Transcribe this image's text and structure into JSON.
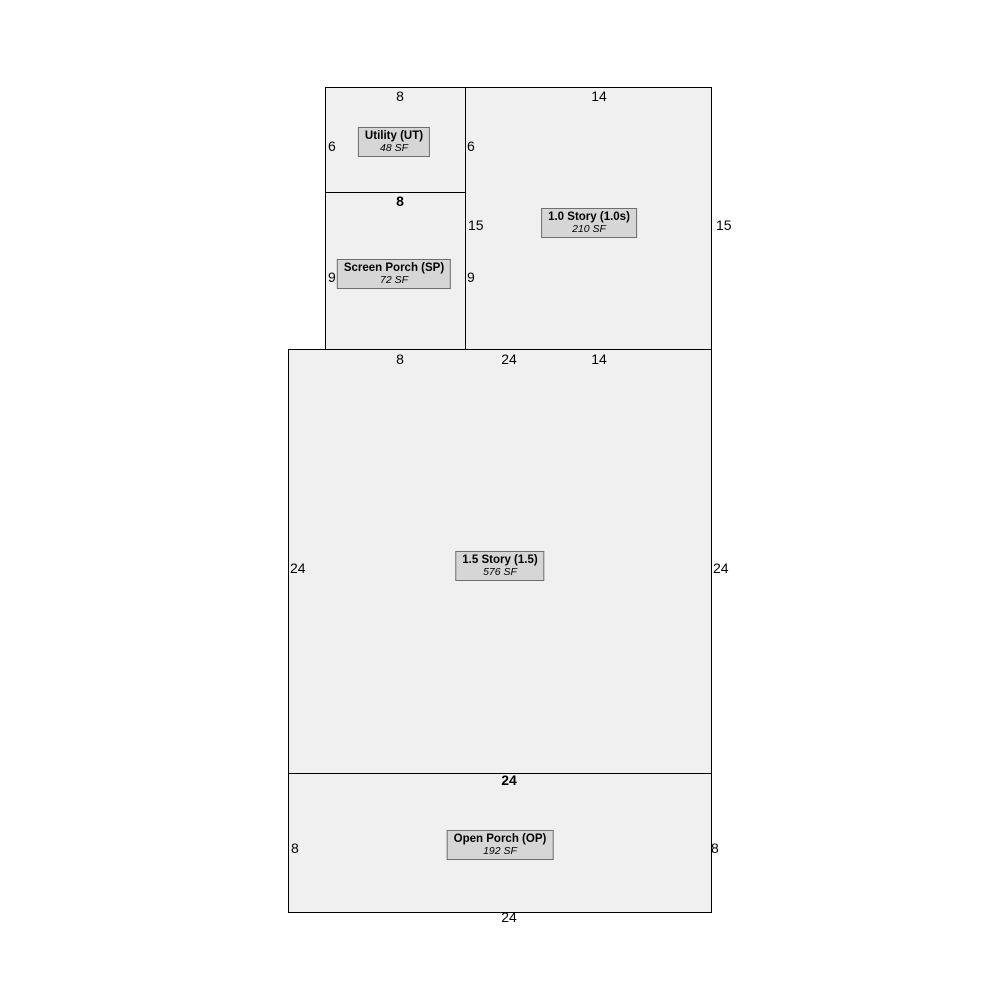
{
  "sketch": {
    "background_color": "#ffffff",
    "region_fill_color": "#f0f0f0",
    "region_border_color": "#000000",
    "label_fill_color": "#d6d6d6",
    "label_border_color": "#6e6e6e",
    "text_color": "#000000"
  },
  "areas": [
    {
      "id": "utility",
      "label": "Utility (UT)",
      "area": "48 SF",
      "rect": {
        "x": 325,
        "y": 87,
        "w": 141,
        "h": 106
      },
      "label_center": {
        "x": 394,
        "y": 142
      }
    },
    {
      "id": "one-story",
      "label": "1.0 Story (1.0s)",
      "area": "210 SF",
      "rect": {
        "x": 465,
        "y": 87,
        "w": 247,
        "h": 263
      },
      "label_center": {
        "x": 589,
        "y": 223
      }
    },
    {
      "id": "screen-porch",
      "label": "Screen Porch (SP)",
      "area": "72 SF",
      "rect": {
        "x": 325,
        "y": 192,
        "w": 141,
        "h": 158
      },
      "label_center": {
        "x": 394,
        "y": 274
      }
    },
    {
      "id": "one-half-story",
      "label": "1.5 Story (1.5)",
      "area": "576 SF",
      "rect": {
        "x": 288,
        "y": 349,
        "w": 424,
        "h": 425
      },
      "label_center": {
        "x": 500,
        "y": 566
      }
    },
    {
      "id": "open-porch",
      "label": "Open Porch (OP)",
      "area": "192 SF",
      "rect": {
        "x": 288,
        "y": 773,
        "w": 424,
        "h": 140
      },
      "label_center": {
        "x": 500,
        "y": 845
      }
    }
  ],
  "dimensions": [
    {
      "value": "8",
      "edge": "utility-top",
      "x": 400,
      "y": 96,
      "anchor": "center",
      "bold": false
    },
    {
      "value": "14",
      "edge": "one-story-top",
      "x": 599,
      "y": 96,
      "anchor": "center",
      "bold": false
    },
    {
      "value": "6",
      "edge": "utility-left",
      "x": 328,
      "y": 146,
      "anchor": "left",
      "bold": false
    },
    {
      "value": "6",
      "edge": "utility-right",
      "x": 467,
      "y": 146,
      "anchor": "left",
      "bold": false
    },
    {
      "value": "8",
      "edge": "utility-bottom",
      "x": 400,
      "y": 201,
      "anchor": "center",
      "bold": true
    },
    {
      "value": "15",
      "edge": "one-story-left",
      "x": 468,
      "y": 225,
      "anchor": "left",
      "bold": false
    },
    {
      "value": "15",
      "edge": "one-story-right",
      "x": 716,
      "y": 225,
      "anchor": "left",
      "bold": false
    },
    {
      "value": "9",
      "edge": "screen-porch-left",
      "x": 328,
      "y": 277,
      "anchor": "left",
      "bold": false
    },
    {
      "value": "9",
      "edge": "screen-porch-right",
      "x": 467,
      "y": 277,
      "anchor": "left",
      "bold": false
    },
    {
      "value": "8",
      "edge": "screen-porch-bottom",
      "x": 400,
      "y": 359,
      "anchor": "center",
      "bold": false
    },
    {
      "value": "24",
      "edge": "one-half-story-top",
      "x": 509,
      "y": 359,
      "anchor": "center",
      "bold": false
    },
    {
      "value": "14",
      "edge": "one-story-bottom",
      "x": 599,
      "y": 359,
      "anchor": "center",
      "bold": false
    },
    {
      "value": "24",
      "edge": "one-half-story-left",
      "x": 290,
      "y": 568,
      "anchor": "left",
      "bold": false
    },
    {
      "value": "24",
      "edge": "one-half-story-right",
      "x": 713,
      "y": 568,
      "anchor": "left",
      "bold": false
    },
    {
      "value": "24",
      "edge": "open-porch-top",
      "x": 509,
      "y": 780,
      "anchor": "center",
      "bold": true
    },
    {
      "value": "8",
      "edge": "open-porch-left",
      "x": 291,
      "y": 848,
      "anchor": "left",
      "bold": false
    },
    {
      "value": "8",
      "edge": "open-porch-right",
      "x": 711,
      "y": 848,
      "anchor": "left",
      "bold": false
    },
    {
      "value": "24",
      "edge": "open-porch-bottom",
      "x": 509,
      "y": 917,
      "anchor": "center",
      "bold": false
    }
  ]
}
